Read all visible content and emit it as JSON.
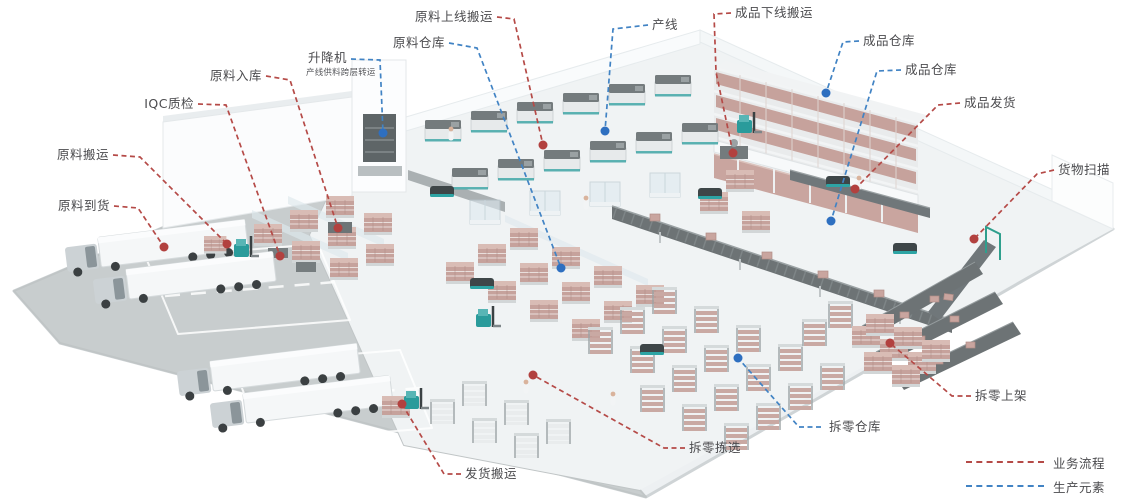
{
  "colors": {
    "process_red": "#b54a47",
    "element_blue": "#4183c4",
    "label_text": "#4b4b4e",
    "floor_white": "#f0f3f4",
    "apron_gray": "#c8cdce",
    "pallet_pink": "#c6a29c",
    "conveyor_gray": "#6d7375",
    "equipment_teal": "#2da0a0"
  },
  "callouts": [
    {
      "id": "raw-material-arrival",
      "label": "原料到货",
      "type": "process"
    },
    {
      "id": "raw-material-handling",
      "label": "原料搬运",
      "type": "process"
    },
    {
      "id": "iqc-inspection",
      "label": "IQC质检",
      "type": "process"
    },
    {
      "id": "raw-material-inbound",
      "label": "原料入库",
      "type": "process"
    },
    {
      "id": "raw-material-line-feed",
      "label": "原料上线搬运",
      "type": "process"
    },
    {
      "id": "lift",
      "label": "升降机",
      "sublabel": "产线供料跨层转运",
      "type": "element"
    },
    {
      "id": "raw-material-warehouse",
      "label": "原料仓库",
      "type": "element"
    },
    {
      "id": "production-line",
      "label": "产线",
      "type": "element"
    },
    {
      "id": "finished-goods-offline",
      "label": "成品下线搬运",
      "type": "process"
    },
    {
      "id": "finished-goods-warehouse-upper",
      "label": "成品仓库",
      "type": "element"
    },
    {
      "id": "finished-goods-warehouse-lower",
      "label": "成品仓库",
      "type": "element"
    },
    {
      "id": "finished-goods-shipping",
      "label": "成品发货",
      "type": "process"
    },
    {
      "id": "cargo-scanning",
      "label": "货物扫描",
      "type": "process"
    },
    {
      "id": "split-case-shelving",
      "label": "拆零上架",
      "type": "process"
    },
    {
      "id": "split-case-warehouse",
      "label": "拆零仓库",
      "type": "element"
    },
    {
      "id": "split-case-picking",
      "label": "拆零拣选",
      "type": "process"
    },
    {
      "id": "shipping-transport",
      "label": "发货搬运",
      "type": "process"
    }
  ],
  "legend": {
    "items": [
      {
        "label": "业务流程",
        "type": "process"
      },
      {
        "label": "生产元素",
        "type": "element"
      }
    ]
  }
}
